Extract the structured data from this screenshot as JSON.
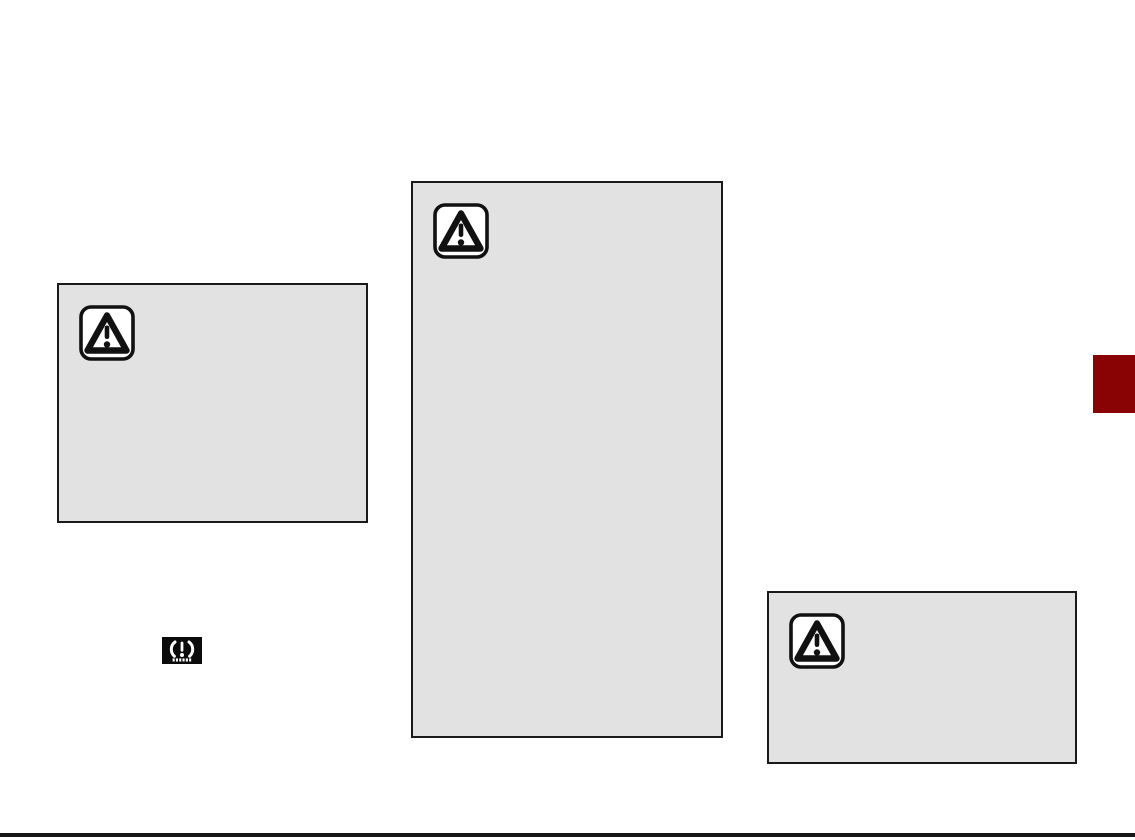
{
  "page": {
    "kind": "owner-manual-scanned-page"
  },
  "colors": {
    "page_bg": "#ffffff",
    "callout_fill": "#e2e2e2",
    "callout_border": "#1a1a1a",
    "icon_ink": "#111111",
    "section_tab": "#8a0304",
    "bottom_rule": "#161616",
    "tpms_bg": "#0b0b0b",
    "tpms_glyph": "#ffffff"
  },
  "callouts": [
    {
      "id": "left",
      "icon": "warning-triangle-icon",
      "text": ""
    },
    {
      "id": "center",
      "icon": "warning-triangle-icon",
      "text": ""
    },
    {
      "id": "right",
      "icon": "warning-triangle-icon",
      "text": ""
    }
  ],
  "indicators": [
    {
      "id": "tpms",
      "icon": "tpms-warning-lamp-icon"
    }
  ],
  "section_tab": {
    "label": ""
  }
}
